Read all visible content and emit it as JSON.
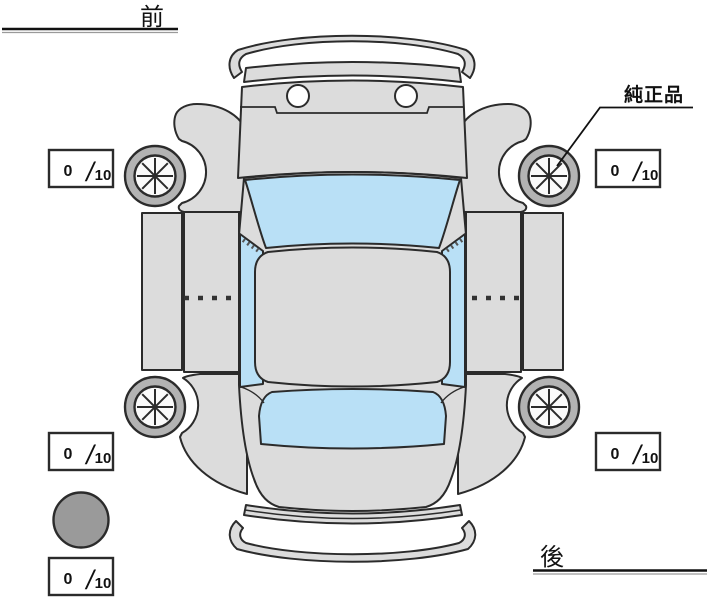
{
  "colors": {
    "line": "#2b2b2b",
    "body": "#dcdcdc",
    "window": "#b9e0f6",
    "tire": "#b3b3b3",
    "rim": "#fafafa",
    "spare": "#9a9a9a",
    "softline": "#9a9a9a"
  },
  "orientation": {
    "front": "前",
    "rear": "後"
  },
  "callout": {
    "genuine_parts": "純正品"
  },
  "tread": {
    "front_left": {
      "value": "0",
      "separator": "/",
      "max": "10"
    },
    "front_right": {
      "value": "0",
      "separator": "/",
      "max": "10"
    },
    "rear_left": {
      "value": "0",
      "separator": "/",
      "max": "10"
    },
    "rear_right": {
      "value": "0",
      "separator": "/",
      "max": "10"
    },
    "spare": {
      "value": "0",
      "separator": "/",
      "max": "10"
    }
  }
}
